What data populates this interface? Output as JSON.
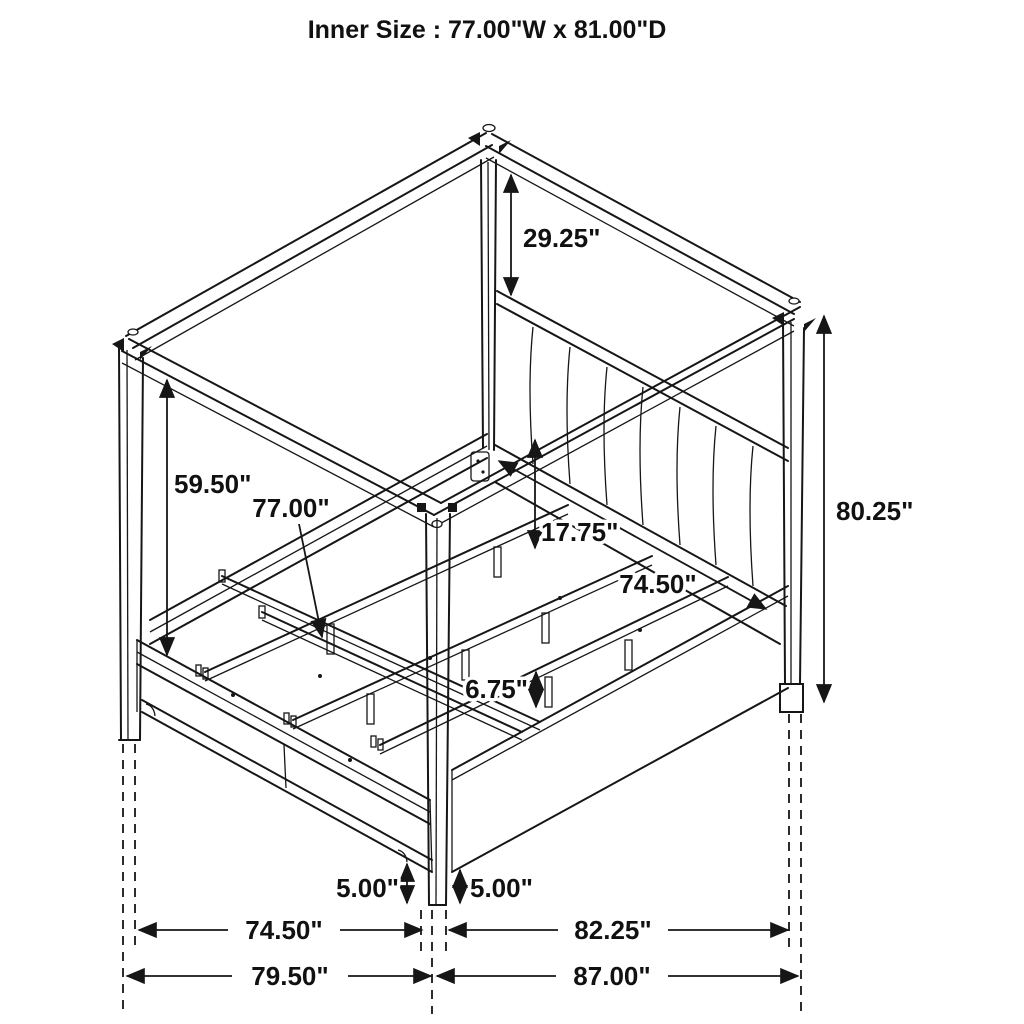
{
  "title": "Inner Size : 77.00\"W x 81.00\"D",
  "drawing": {
    "subject": "canopy-storage-bed-isometric-line-drawing"
  },
  "dims": {
    "canopy_drop": "29.25\"",
    "post_opening_height": "59.50\"",
    "slat_width": "77.00\"",
    "headboard_panel_height": "17.75\"",
    "headboard_inner_width": "74.50\"",
    "overall_height": "80.25\"",
    "slat_leg_height": "6.75\"",
    "foot_clearance_left": "5.00\"",
    "foot_clearance_right": "5.00\"",
    "inner_width_bottom": "74.50\"",
    "overall_width_bottom": "79.50\"",
    "inner_depth_bottom": "82.25\"",
    "overall_depth_bottom": "87.00\""
  }
}
